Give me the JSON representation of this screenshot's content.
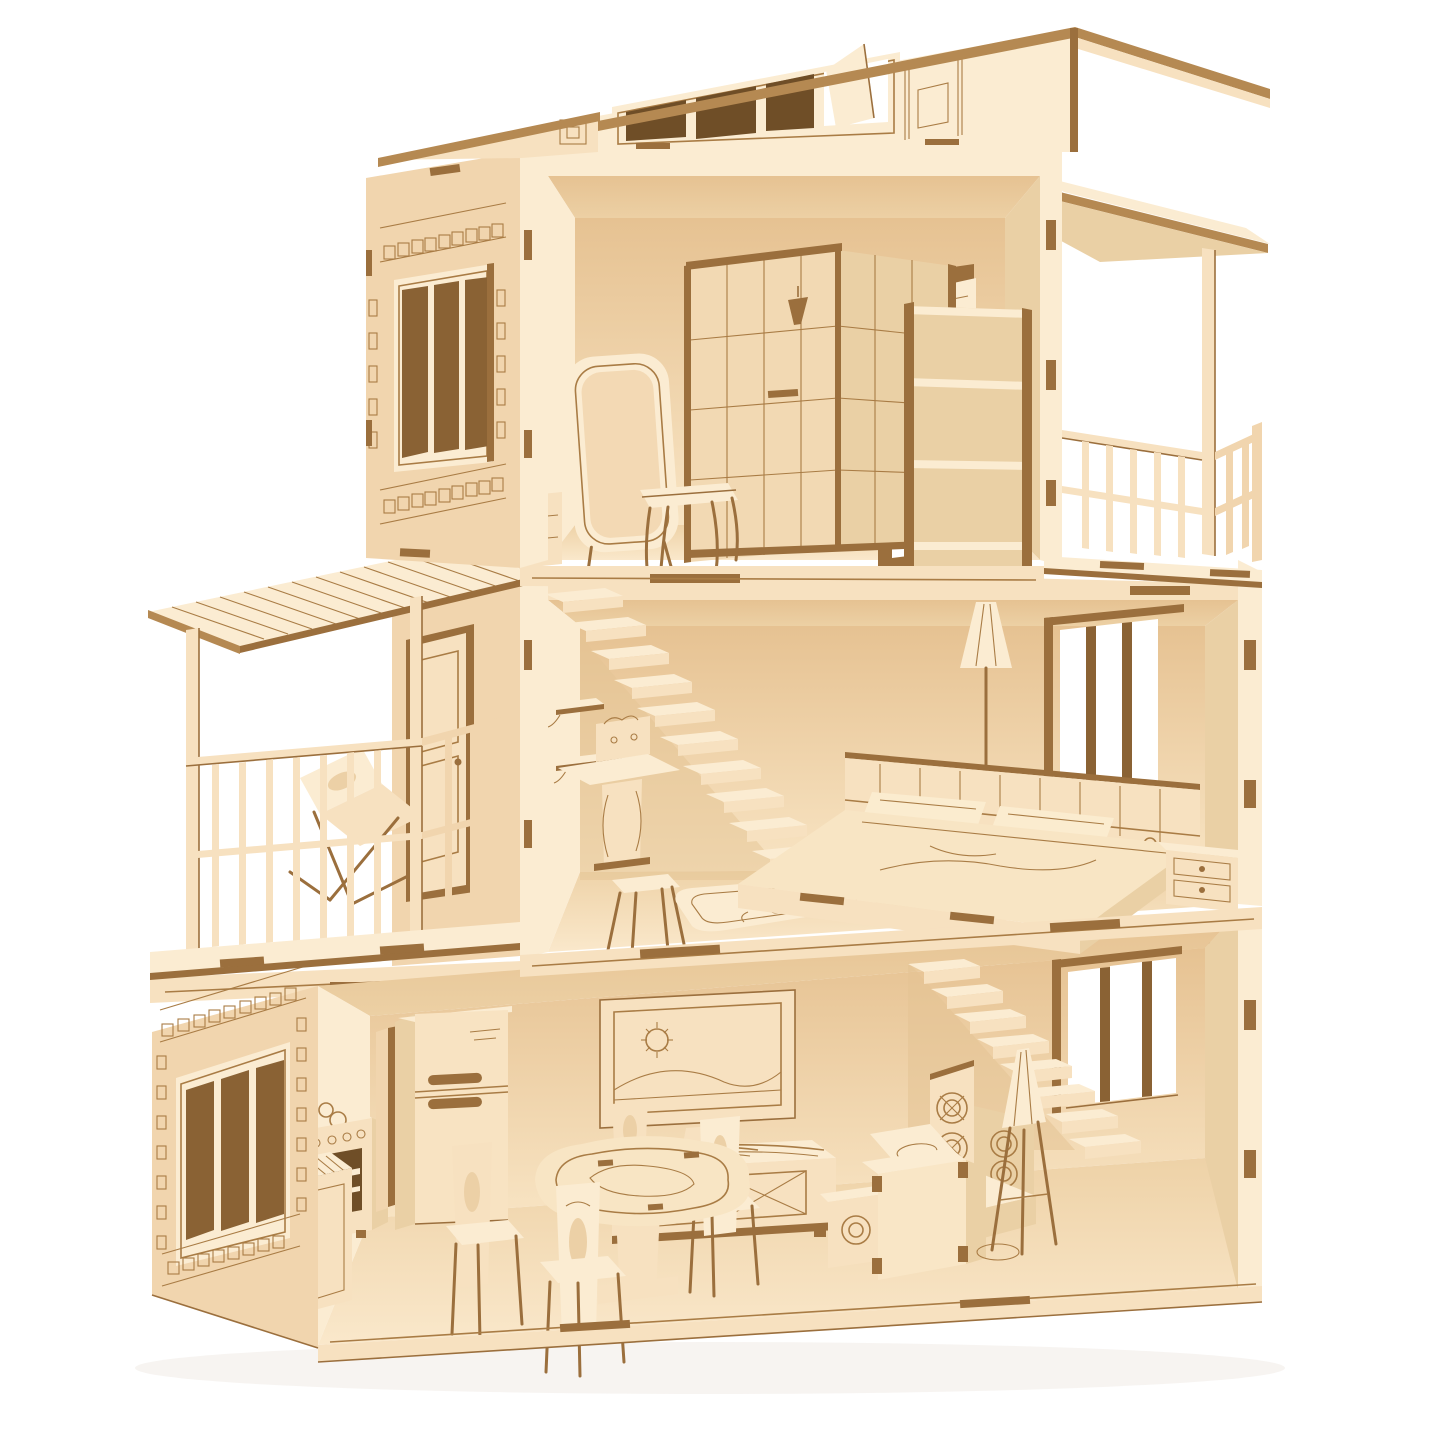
{
  "scene": {
    "label": "Laser-cut plywood dollhouse with three open floors, furniture, two balconies and a slanted clerestory roof",
    "material": "plywood",
    "floors": [
      {
        "name": "third-floor-bathroom",
        "items": [
          "clerestory-roof-window",
          "side-wall-window",
          "corner-shower",
          "standing-mirror",
          "stool",
          "small-dresser",
          "balcony-door",
          "shelf-unit",
          "right-balcony-with-railing"
        ]
      },
      {
        "name": "second-floor-bedroom",
        "items": [
          "floating-staircase",
          "wall-shelves",
          "dressing-table",
          "stool",
          "rug",
          "double-bed-with-pillows",
          "floor-lamp",
          "nightstand",
          "bedroom-window",
          "left-balcony-with-pergola",
          "lounge-chair",
          "balcony-door"
        ]
      },
      {
        "name": "first-floor-kitchen-living",
        "items": [
          "kitchen-stove",
          "sink-counter",
          "partition-wall",
          "refrigerator",
          "tv-on-cabinet",
          "round-dining-table",
          "four-chairs",
          "corner-sofa-with-rosettes",
          "box-table",
          "floor-lamp",
          "staircase",
          "side-wall-window",
          "living-room-window"
        ]
      }
    ]
  },
  "colors": {
    "background": "#ffffff",
    "faceBright": "#fbecd2",
    "faceFront": "#f7e1c0",
    "faceSide": "#f1d5ae",
    "interiorCeil": "#ecd0a4",
    "wallTop": "#e6c292",
    "wallBottom": "#f8e4c3",
    "floorTop": "#eed2a7",
    "floorBottom": "#fae8cb",
    "dimFace": "#ead0a5",
    "edgeDark": "#9b6f3d",
    "engrave": "#a97c45",
    "paneDark": "#8a6234",
    "paneDarker": "#6f4e27",
    "roofStrip": "#b58952",
    "openWhite": "#ffffff"
  }
}
